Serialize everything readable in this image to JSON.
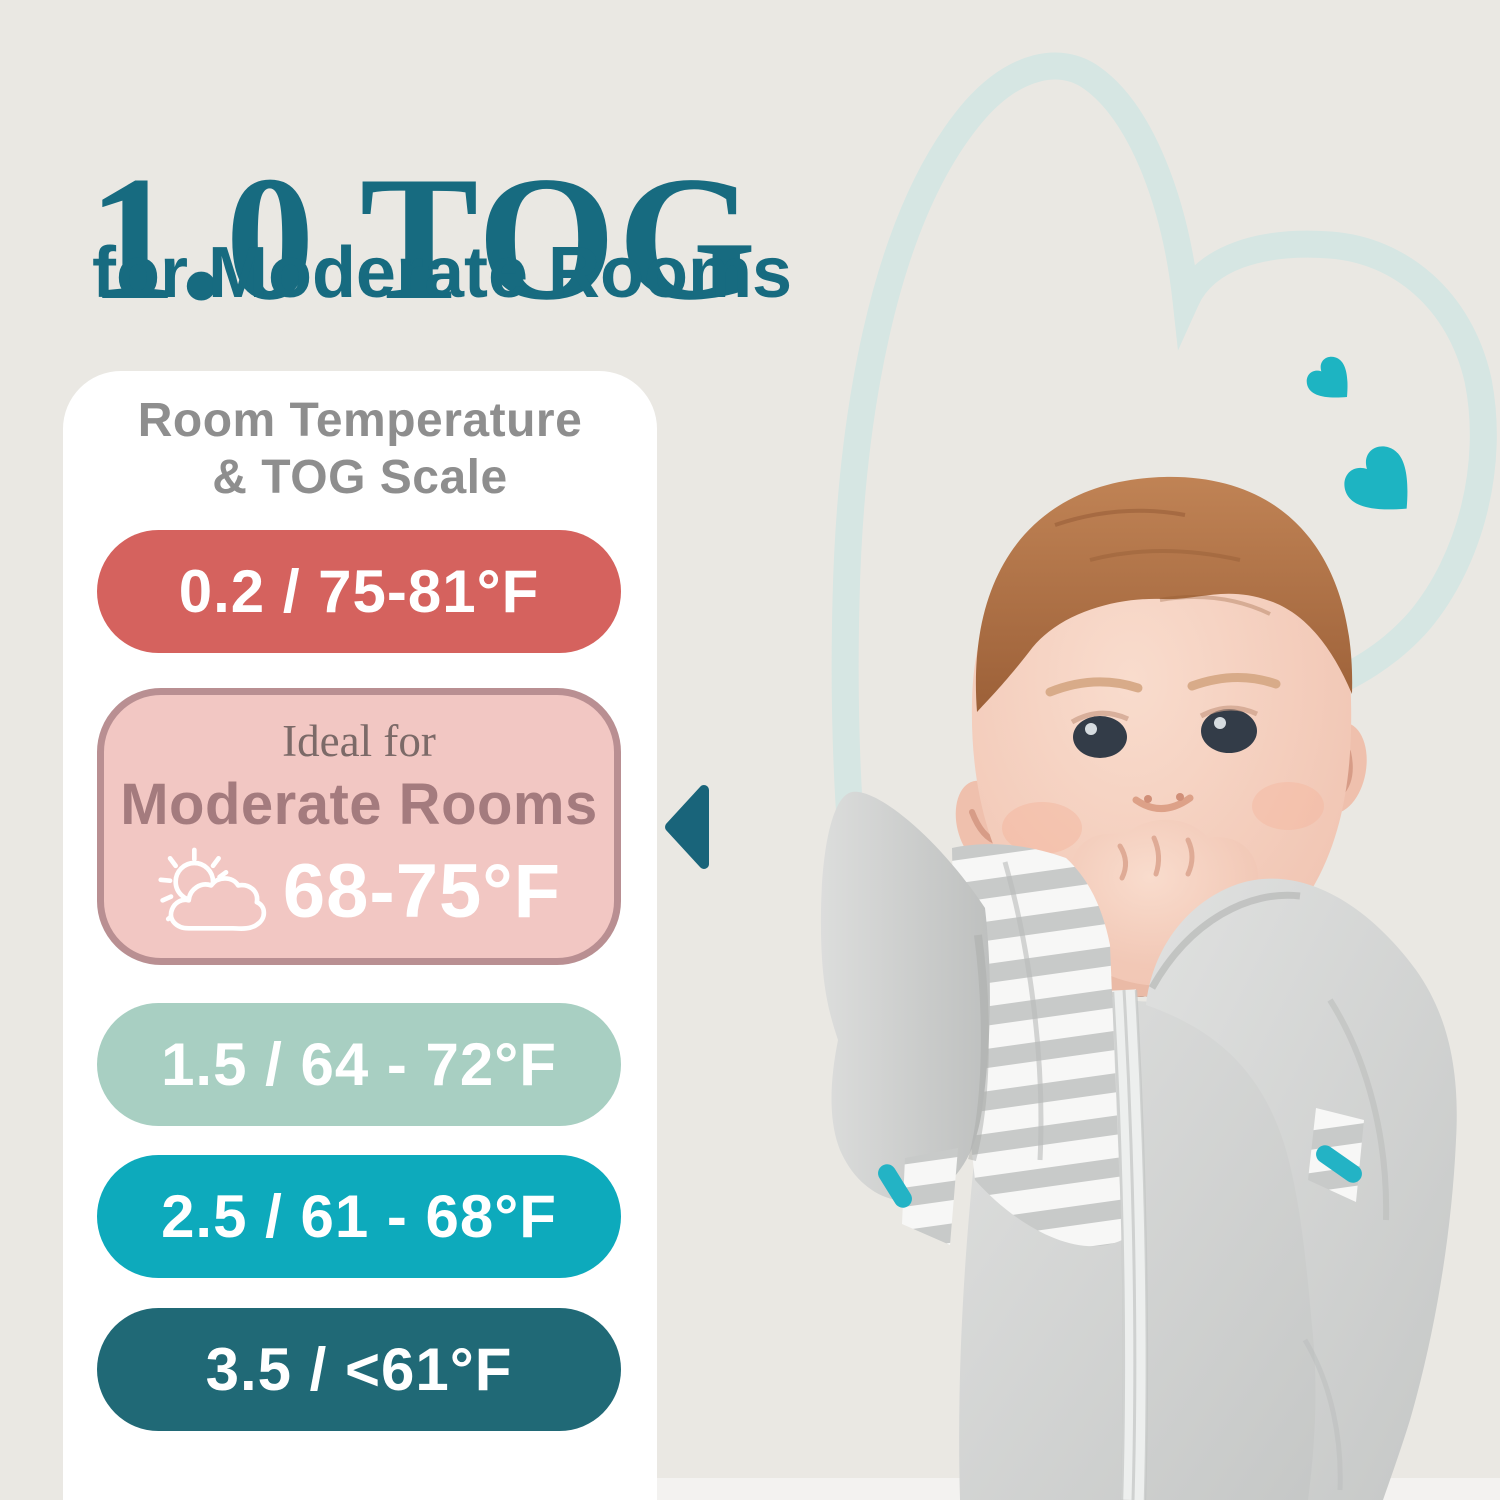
{
  "header": {
    "title": "1.0 TOG",
    "subtitle": "for Moderate Rooms"
  },
  "card": {
    "heading_line1": "Room Temperature",
    "heading_line2": "& TOG Scale",
    "scale": [
      {
        "label": "0.2 / 75-81°F",
        "bg": "#d5625e",
        "text_color": "#ffffff"
      },
      {
        "intro": "Ideal for",
        "name": "Moderate Rooms",
        "temp": "68-75°F",
        "bg": "#f2c7c3",
        "border_color": "#b98f92",
        "intro_color": "#7c6a68",
        "name_color": "#a47b7e",
        "temp_color": "#ffffff",
        "icon": "sun-behind-cloud-icon"
      },
      {
        "label": "1.5 / 64 - 72°F",
        "bg": "#a8cfc2",
        "text_color": "#ffffff"
      },
      {
        "label": "2.5 / 61 - 68°F",
        "bg": "#0daabc",
        "text_color": "#ffffff"
      },
      {
        "label": "3.5 / <61°F",
        "bg": "#206976",
        "text_color": "#ffffff"
      }
    ]
  },
  "pointer": {
    "icon": "left-triangle-arrow-icon",
    "color": "#19647a"
  },
  "decor": {
    "background": "#eae8e3",
    "card_bg": "#ffffff",
    "title_color": "#176b80",
    "heading_color": "#8e8e8e",
    "hearts_icon": "tilted-heart-icon",
    "hearts_color": "#1db4c2",
    "heart_outline_icon": "sketched-heart-outline",
    "heart_outline_color": "#d6e6e3"
  },
  "photo": {
    "description": "Smiling baby in gray swaddle-up sleep sack chewing fist"
  }
}
